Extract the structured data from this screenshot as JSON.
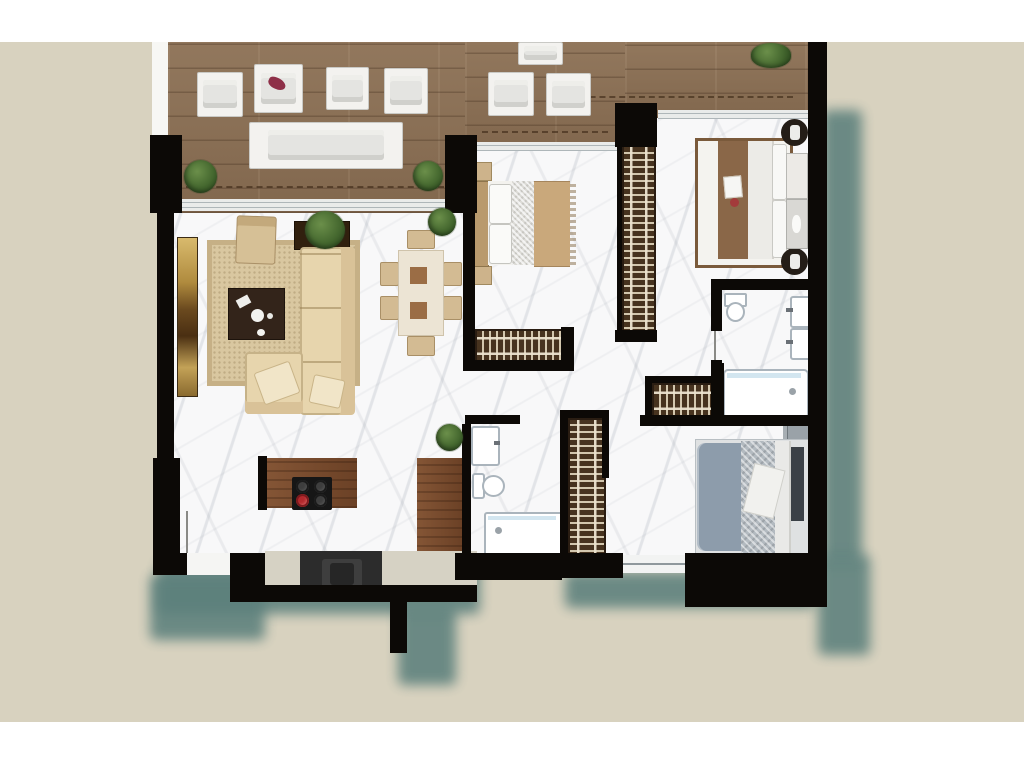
{
  "scene": {
    "description": "Rendered top-down 3D floor plan of a three-bedroom apartment with wide wooden terrace; no text labels anywhere in the image",
    "text_content": "none"
  },
  "areas": {
    "terrace": "terrace with wood deck and outdoor lounge furniture",
    "living_room": "living room with L-shaped sofa, rug, coffee table, TV sideboard",
    "dining_area": "dining table with six chairs",
    "kitchen": "kitchen with cooktop counter, side counter and sink unit",
    "hallway": "central hallway with built-in wardrobes",
    "bedroom_top_middle": "bedroom with double bed, tan cover, corridor wardrobe",
    "bedroom_top_right": "master bedroom with double bed, round side tables, dresser",
    "bedroom_bottom_right": "bedroom with blue-grey double bed and wardrobe",
    "bathroom_ensuite": "en-suite bathroom with double vanity, toilet and bathtub",
    "bathroom_hall": "hall bathroom with vanity, toilet and shower tray"
  },
  "counts": {
    "dining_chairs": 6,
    "cooktop_burners": 4,
    "red_burners": 1,
    "wardrobes": 4,
    "potted_plants": 6,
    "bedrooms": 3,
    "bathrooms": 2
  },
  "palette": {
    "page_margin": "#d8d2bf",
    "top_bottom_band": "#ffffff",
    "drop_shadow_teal": "#5c807c",
    "wall_black": "#0c0906",
    "terrace_deck_wood": "#8b7055",
    "interior_marble": "#f8f8f9",
    "area_rug": "#d9c7a0",
    "sofa_beige": "#e7d5ad",
    "coffee_table_brown": "#33241a",
    "tv_sideboard_gold": "#c9a75e",
    "dining_table_cream": "#ece4d4",
    "dining_square_brown": "#9b6d45",
    "kitchen_counter_wood": "#7a4a2b",
    "cooktop_black": "#161616",
    "burner_red": "#b3282c",
    "kitchen_strip": "#d6d2c4",
    "wardrobe_dark": "#47331f",
    "wardrobe_stripe": "#d3c7ae",
    "bed_cover_tan": "#c9a87b",
    "bed_runner_brown": "#8a6748",
    "bed_blue_grey": "#8d9cab",
    "headboard_dark": "#3b4046",
    "fixture_outline": "#aab4bc",
    "tub_water": "#d3e6f0",
    "plant_green": "#45682f",
    "outdoor_furniture_white": "#f3f2ef"
  }
}
